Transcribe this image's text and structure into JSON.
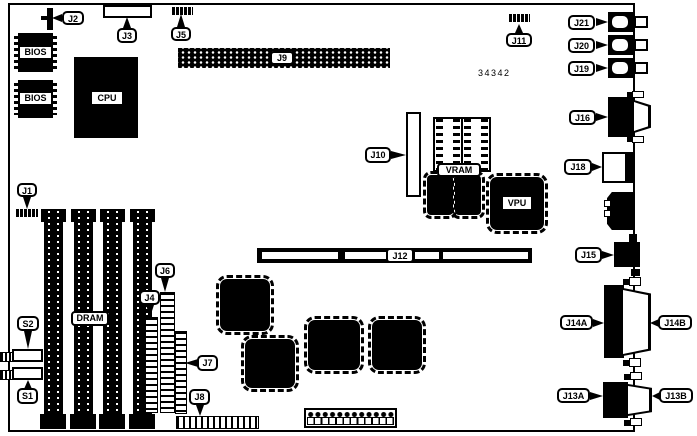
{
  "diagram": {
    "part_number": "34342",
    "chips": {
      "bios1": "BIOS",
      "bios2": "BIOS",
      "cpu": "CPU",
      "dram": "DRAM",
      "vram": "VRAM",
      "vpu": "VPU"
    },
    "callouts": {
      "j1": "J1",
      "j2": "J2",
      "j3": "J3",
      "j4": "J4",
      "j5": "J5",
      "j6": "J6",
      "j7": "J7",
      "j8": "J8",
      "j9": "J9",
      "j10": "J10",
      "j11": "J11",
      "j12": "J12",
      "j13a": "J13A",
      "j13b": "J13B",
      "j14a": "J14A",
      "j14b": "J14B",
      "j15": "J15",
      "j16": "J16",
      "j18": "J18",
      "j19": "J19",
      "j20": "J20",
      "j21": "J21",
      "s1": "S1",
      "s2": "S2"
    },
    "colors": {
      "line": "#000000",
      "background": "#ffffff"
    }
  }
}
